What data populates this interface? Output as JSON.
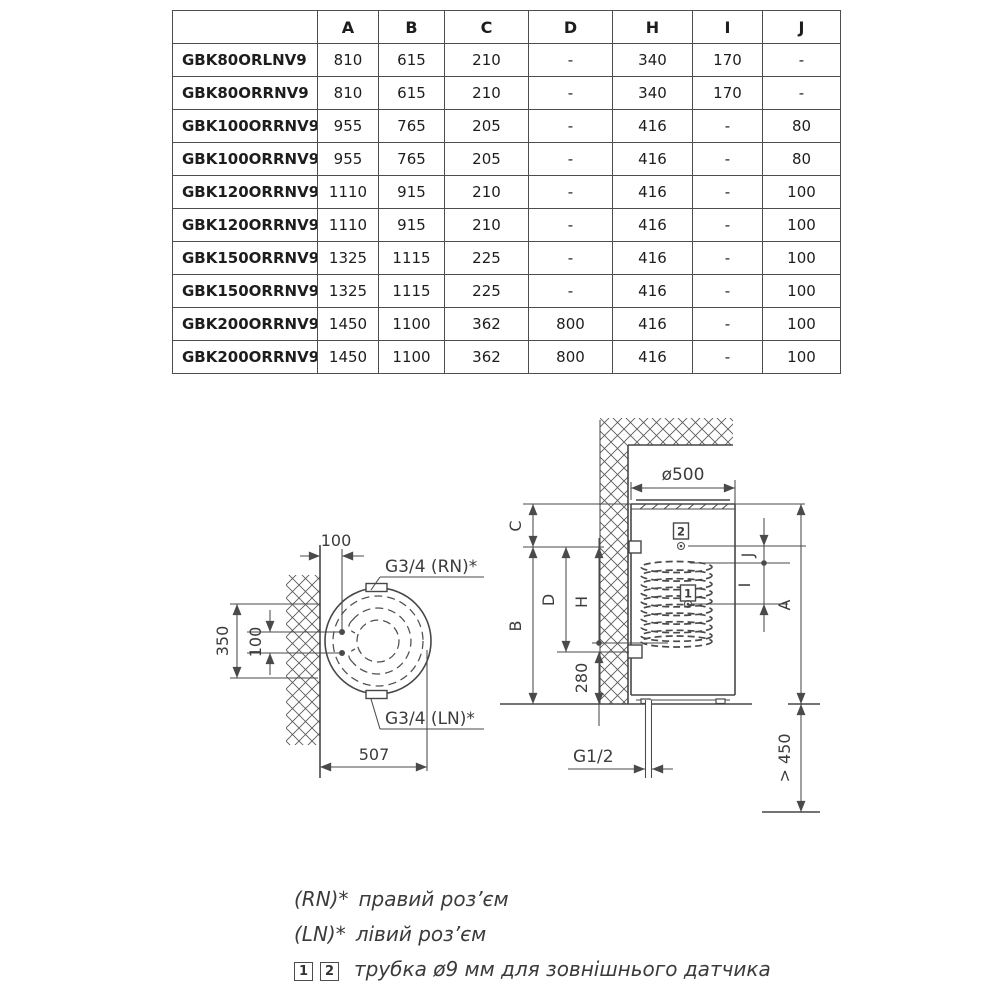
{
  "table": {
    "columns": [
      "",
      "A",
      "B",
      "C",
      "D",
      "H",
      "I",
      "J"
    ],
    "rows": [
      {
        "model": "GBK80ORLNV9",
        "values": [
          "810",
          "615",
          "210",
          "-",
          "340",
          "170",
          "-"
        ]
      },
      {
        "model": "GBK80ORRNV9",
        "values": [
          "810",
          "615",
          "210",
          "-",
          "340",
          "170",
          "-"
        ]
      },
      {
        "model": "GBK100ORRNV9",
        "values": [
          "955",
          "765",
          "205",
          "-",
          "416",
          "-",
          "80"
        ]
      },
      {
        "model": "GBK100ORRNV9",
        "values": [
          "955",
          "765",
          "205",
          "-",
          "416",
          "-",
          "80"
        ]
      },
      {
        "model": "GBK120ORRNV9",
        "values": [
          "1110",
          "915",
          "210",
          "-",
          "416",
          "-",
          "100"
        ]
      },
      {
        "model": "GBK120ORRNV9",
        "values": [
          "1110",
          "915",
          "210",
          "-",
          "416",
          "-",
          "100"
        ]
      },
      {
        "model": "GBK150ORRNV9",
        "values": [
          "1325",
          "1115",
          "225",
          "-",
          "416",
          "-",
          "100"
        ]
      },
      {
        "model": "GBK150ORRNV9",
        "values": [
          "1325",
          "1115",
          "225",
          "-",
          "416",
          "-",
          "100"
        ]
      },
      {
        "model": "GBK200ORRNV9",
        "values": [
          "1450",
          "1100",
          "362",
          "800",
          "416",
          "-",
          "100"
        ]
      },
      {
        "model": "GBK200ORRNV9",
        "values": [
          "1450",
          "1100",
          "362",
          "800",
          "416",
          "-",
          "100"
        ]
      }
    ]
  },
  "diagram": {
    "top_view": {
      "dim_offset": "100",
      "dim_height": "350",
      "dim_spacing": "100",
      "dim_width": "507",
      "label_rn": "G3/4 (RN)*",
      "label_ln": "G3/4 (LN)*"
    },
    "front_view": {
      "dim_diameter": "ø500",
      "dim_c": "C",
      "dim_b": "B",
      "dim_d": "D",
      "dim_h": "H",
      "dim_280": "280",
      "dim_j": "J",
      "dim_i": "I",
      "dim_a": "A",
      "dim_clearance": "> 450",
      "label_g12": "G1/2",
      "marker_1": "1",
      "marker_2": "2"
    }
  },
  "legend": {
    "rn": {
      "prefix": "(RN)*",
      "text": "правий роз’єм"
    },
    "ln": {
      "prefix": "(LN)*",
      "text": "лівий роз’єм"
    },
    "sensors": {
      "marker_1": "1",
      "marker_2": "2",
      "text": "трубка ø9 мм для зовнішнього датчика"
    }
  }
}
